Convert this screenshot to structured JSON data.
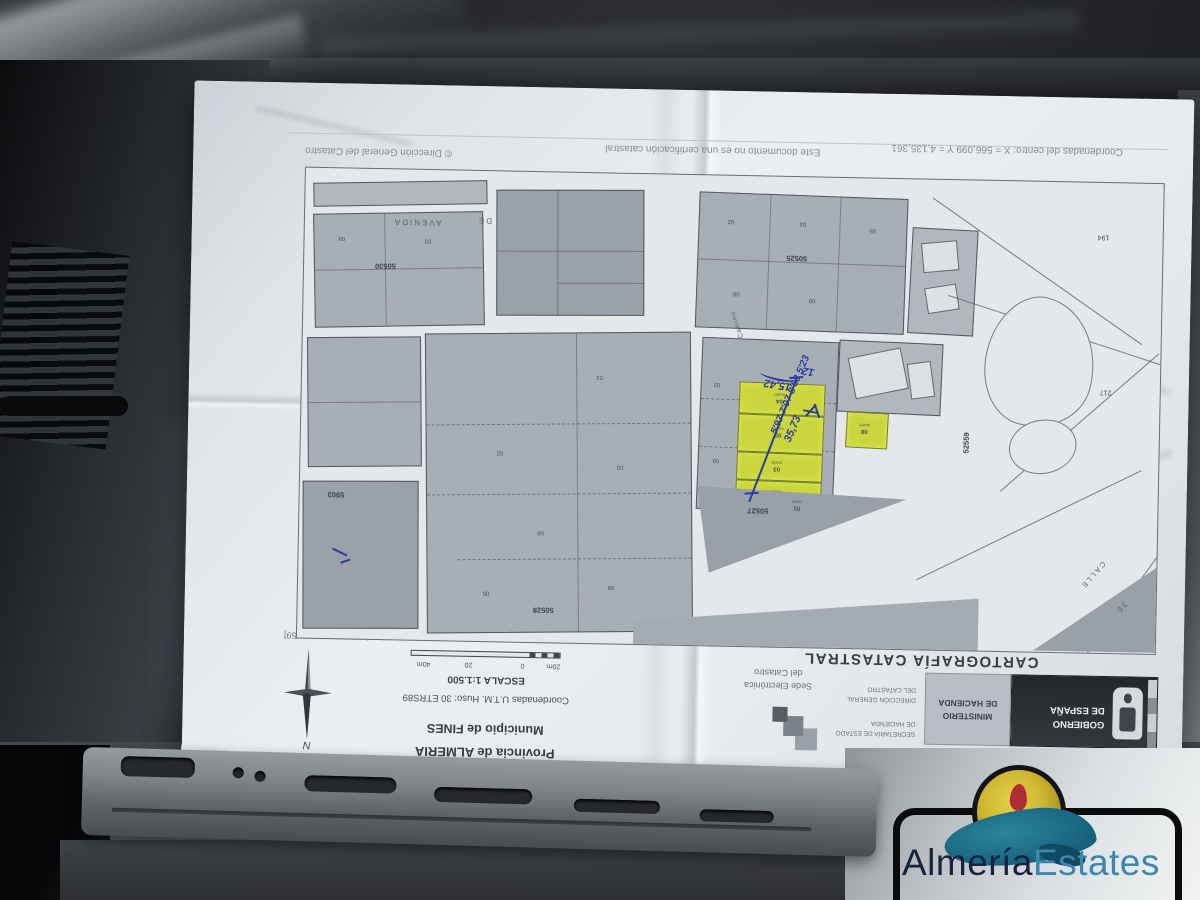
{
  "photo": {
    "description": "Photograph of a Spanish cadastral map sheet lying upside down on a car dashboard",
    "watermark": {
      "brand_part1": "Almería",
      "brand_part2": "Estates",
      "color_part1": "#16223e",
      "color_part2": "#3d85ad"
    }
  },
  "document": {
    "title": "CARTOGRAFÍA CATASTRAL",
    "province": "Provincia de ALMERÍA",
    "municipality": "Municipio de FINES",
    "utm": "Coordenadas U.T.M. Huso: 30 ETRS89",
    "scale": "ESCALA 1:1.500",
    "scalebar": {
      "labels": [
        "20m",
        "0",
        "20",
        "40m"
      ]
    },
    "north_label": "N",
    "logos": {
      "government_line1": "GOBIERNO",
      "government_line2": "DE ESPAÑA",
      "ministry_line1": "MINISTERIO",
      "ministry_line2": "DE HACIENDA",
      "secretary_line1": "SECRETARÍA DE ESTADO",
      "secretary_line2": "DE HACIENDA",
      "directorate_line1": "DIRECCIÓN GENERAL",
      "directorate_line2": "DEL CATASTRO",
      "sede_line1": "Sede Electrónica",
      "sede_line2": "del Catastro"
    },
    "footer": {
      "center_coords": "Coordenadas del centro: X = 566,099 Y = 4,135,361",
      "disclaimer": "Este documento no es una certificación catastral",
      "copyright": "© Dirección General del Catastro"
    },
    "map_corners": {
      "screen_top_left": "[566,279 ; 4,135,264]",
      "screen_top_right": "[565,919 ; 4,135,264]",
      "screen_bottom_left": "[566,279 ; 4,135,459]",
      "screen_bottom_right": "[565,919 ; 4,135,459]"
    }
  },
  "map": {
    "streets": {
      "avenida": "AVENIDA",
      "de": "DE",
      "calle": "CALLE",
      "calle_num": "36",
      "camino": "Camino"
    },
    "block_numbers": {
      "b1": "50530",
      "b2": "50528",
      "b3": "50525",
      "b4": "50527",
      "b5": "50523",
      "b6": "5903",
      "b7": "52559"
    },
    "land_labels": {
      "l1": "217",
      "l2": "194"
    },
    "parcels": {
      "yellow": [
        {
          "num": "04",
          "type": "suelo"
        },
        {
          "num": "05",
          "type": "suelo"
        },
        {
          "num": "03",
          "type": "suelo"
        },
        {
          "num": "06",
          "type": "suelo"
        }
      ],
      "yellow_single": {
        "num": "08",
        "type": "suelo"
      },
      "triangle": {
        "num": "01",
        "type": "suelo"
      },
      "b1": [
        "04",
        "03"
      ],
      "b2": [
        "01",
        "02",
        "03",
        "06",
        "09",
        "05"
      ],
      "b3": [
        "02",
        "03",
        "05",
        "08",
        "09"
      ],
      "b7left": [
        "02",
        "09"
      ]
    }
  },
  "annotations": {
    "ink_color": "#2c3c9e",
    "measure_a": "15,42",
    "measure_b": "12",
    "total_length": "35,73",
    "series": "5'97 7'07 8'68 5'23"
  }
}
